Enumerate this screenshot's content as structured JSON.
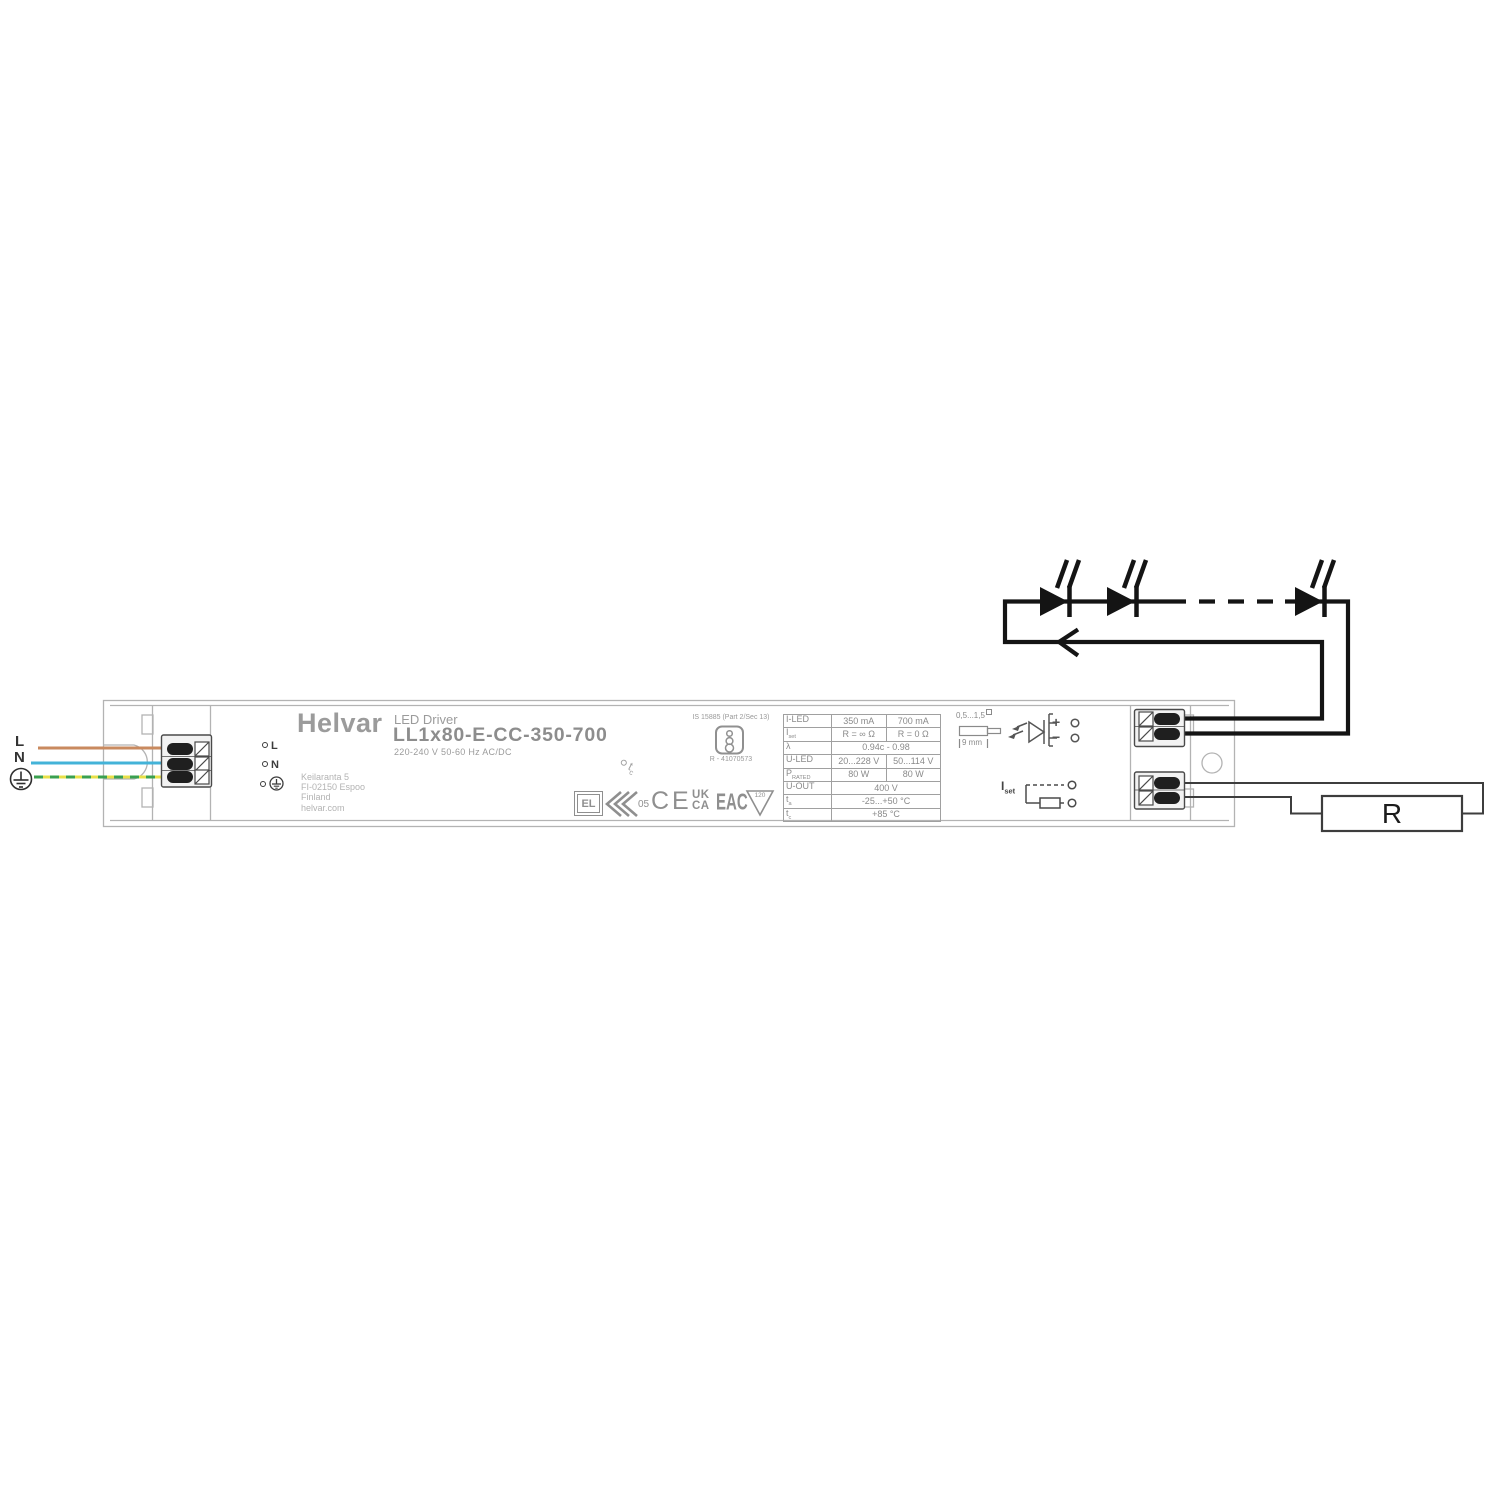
{
  "input": {
    "l_label": "L",
    "n_label": "N"
  },
  "device": {
    "brand": "Helvar",
    "product_type": "LED Driver",
    "model": "LL1x80-E-CC-350-700",
    "rating": "220-240 V 50-60 Hz AC/DC",
    "address_lines": [
      "Keilaranta 5",
      "FI-02150 Espoo",
      "Finland",
      "helvar.com"
    ],
    "terminal_l": "L",
    "terminal_n": "N",
    "tc_main": "t",
    "tc_sub": "c"
  },
  "bis": {
    "standard": "IS 15885 (Part 2/Sec 13)",
    "registration": "R - 41070573"
  },
  "certs": {
    "el": "EL",
    "num": "05",
    "ce": "CE",
    "uk": "UK",
    "ca": "CA",
    "eac": "EAC",
    "triangle_temp": "120"
  },
  "spec_table": {
    "rows": [
      {
        "label": "I-LED",
        "sub": "",
        "v1": "350 mA",
        "v2": "700 mA"
      },
      {
        "label": "I",
        "sub": "set",
        "v1": "R = ∞ Ω",
        "v2": "R = 0 Ω"
      },
      {
        "label": "λ",
        "sub": "",
        "span": "0.94c - 0.98"
      },
      {
        "label": "U-LED",
        "sub": "",
        "v1": "20...228 V",
        "v2": "50...114 V"
      },
      {
        "label": "P",
        "sub": "RATED",
        "v1": "80 W",
        "v2": "80 W"
      },
      {
        "label": "U-OUT",
        "sub": "",
        "span": "400 V"
      },
      {
        "label": "t",
        "sub": "a",
        "span": "-25...+50 °C"
      },
      {
        "label": "t",
        "sub": "c",
        "span": "+85 °C"
      }
    ]
  },
  "output": {
    "wire_gauge": "0,5...1,5",
    "strip_length": "9 mm",
    "plus": "+",
    "minus": "−",
    "iset_main": "I",
    "iset_sub": "set"
  },
  "load": {
    "resistor_label": "R"
  },
  "colors": {
    "wire_l": "#c98a5f",
    "wire_n": "#43b3d8",
    "wire_pe_yellow": "#e8e049",
    "wire_pe_green": "#3aa04f",
    "led_wire": "#141414",
    "signal_wire": "#3d3d3d",
    "case_line": "#b3b3b3"
  }
}
